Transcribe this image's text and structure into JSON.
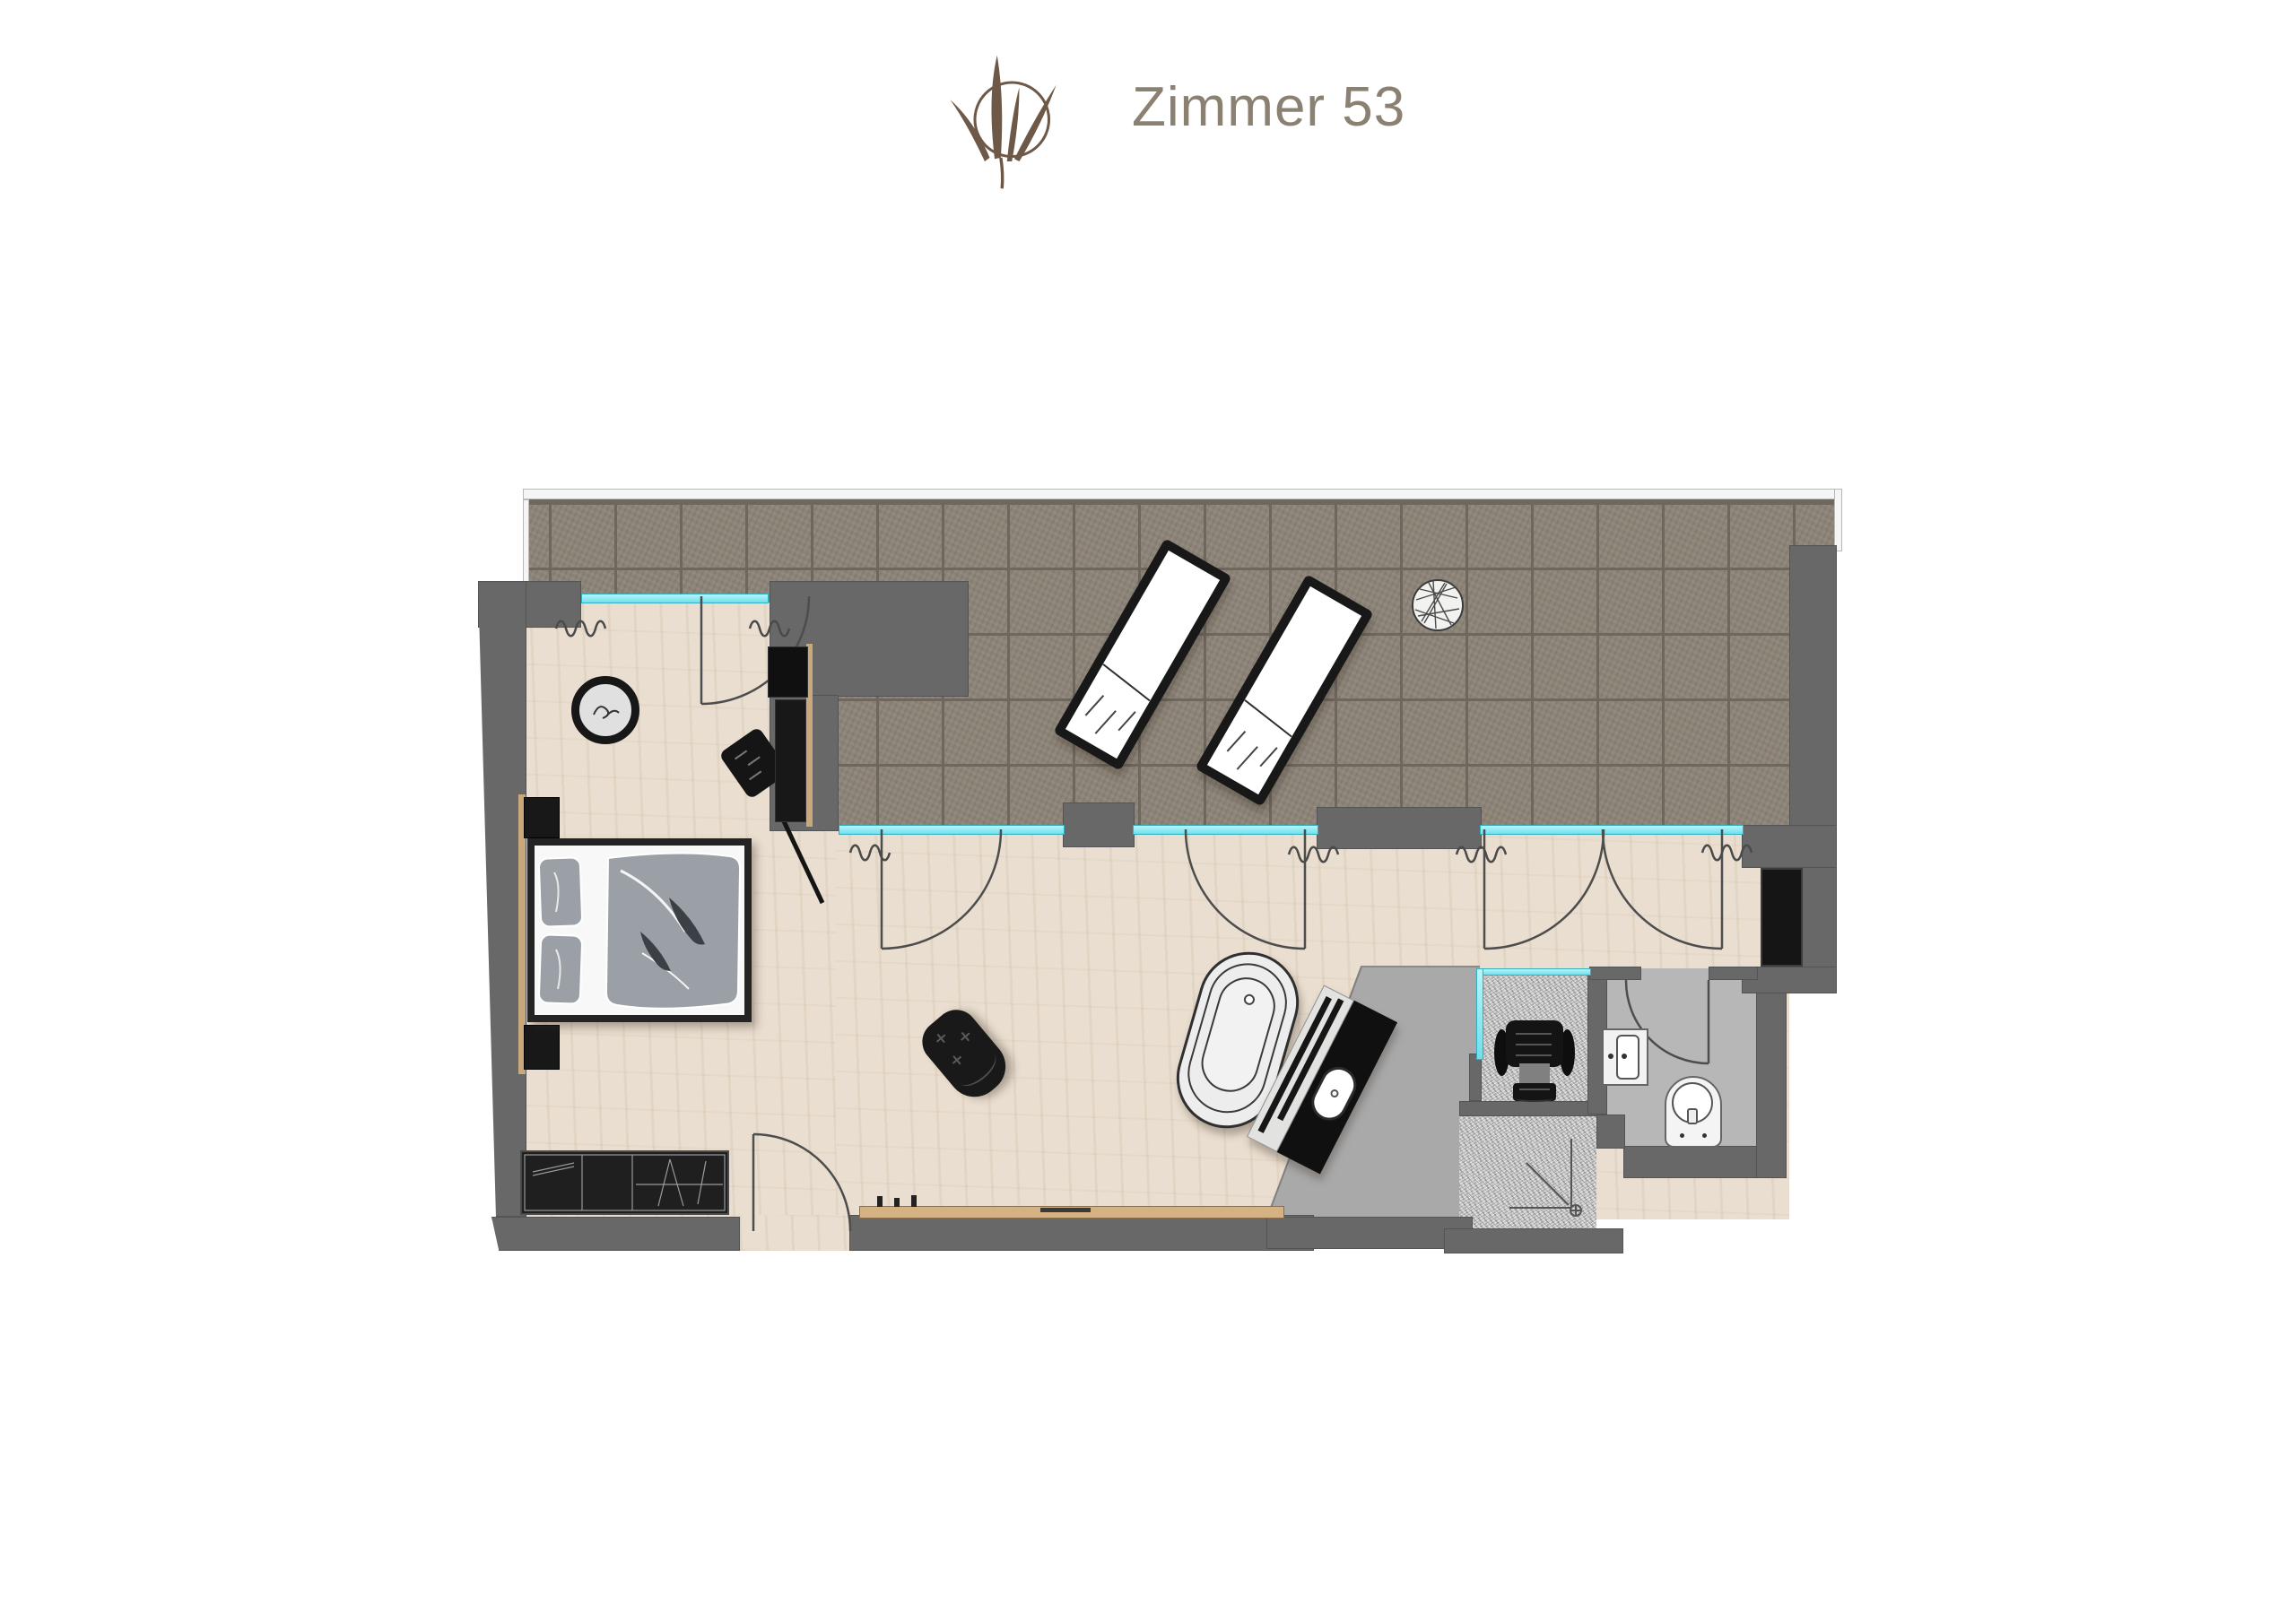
{
  "header": {
    "title": "Zimmer 53"
  },
  "logo": {
    "name": "plant-logo",
    "color": "#6e5847"
  },
  "palette": {
    "title_text": "#8b8173",
    "wall": "#686868",
    "window_glass": "#7de9f3",
    "terrace_tile": "#8d8478",
    "wood_floor": "#e9decf",
    "bath_floor": "#a9a9a9",
    "wc_floor": "#b7b7b7",
    "granite": "#c7c7c7",
    "furniture_dark": "#181818",
    "bedding_gray": "#9aa0a6",
    "wood_accent": "#c9a87c"
  },
  "floorplan": {
    "rooms": [
      "terrace",
      "bedroom",
      "living-area",
      "bathroom",
      "infrared-cabin",
      "shower",
      "wc",
      "hall"
    ],
    "furniture": [
      "sun-lounger",
      "sun-lounger",
      "terrace-side-table",
      "double-bed",
      "nightstand",
      "nightstand",
      "wardrobe",
      "hanging-chair",
      "stool",
      "tv-panel",
      "armchair",
      "sideboard-bench",
      "freestanding-bathtub",
      "vanity-washstand",
      "relax-chair",
      "washbasin",
      "toilet",
      "tall-cabinet"
    ]
  }
}
